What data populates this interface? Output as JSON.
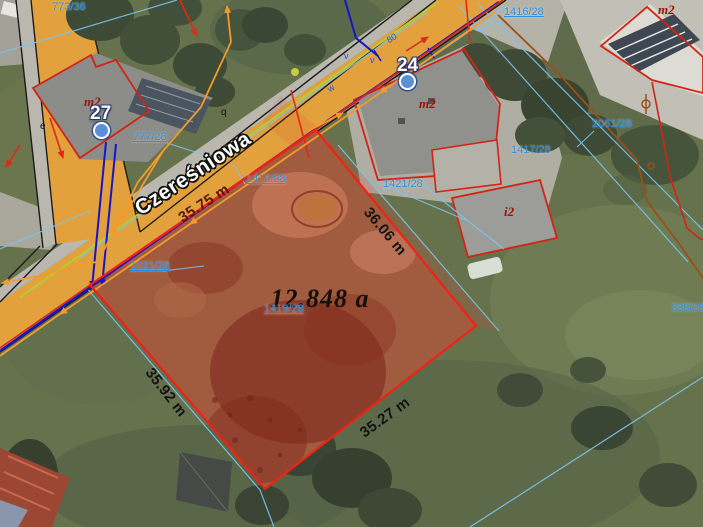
{
  "map": {
    "street_name": "Czereśniowa",
    "area_label": "12.848 a",
    "measurements": {
      "north": "35.75 m",
      "east": "36.06 m",
      "west": "35.92 m",
      "south": "35.27 m"
    },
    "house_numbers": [
      "27",
      "24"
    ],
    "parcel_numbers": [
      "773/36",
      "777/28",
      "1416/28",
      "1418/28",
      "1021/28",
      "1419/28",
      "1421/28",
      "1417/28",
      "2061/28",
      "388/28"
    ],
    "building_labels": [
      "m2",
      "m2",
      "m2",
      "i2"
    ],
    "tiny_marks": [
      "e",
      "q",
      "v",
      "v",
      "80",
      "w"
    ],
    "colors": {
      "road_fill": "#e2a13c",
      "sidewalk_fill": "#b9b7ae",
      "parcel_highlight": "#f32015",
      "cadastral_line": "#7cc4ee",
      "parcel_label": "#2e8fe0",
      "utility_power": "#1616c8",
      "utility_orange": "#f59a28",
      "utility_yellow_green": "#b7cb35",
      "utility_brown": "#99501d",
      "building_outline": "#d42316",
      "building_label": "#a01208"
    }
  }
}
